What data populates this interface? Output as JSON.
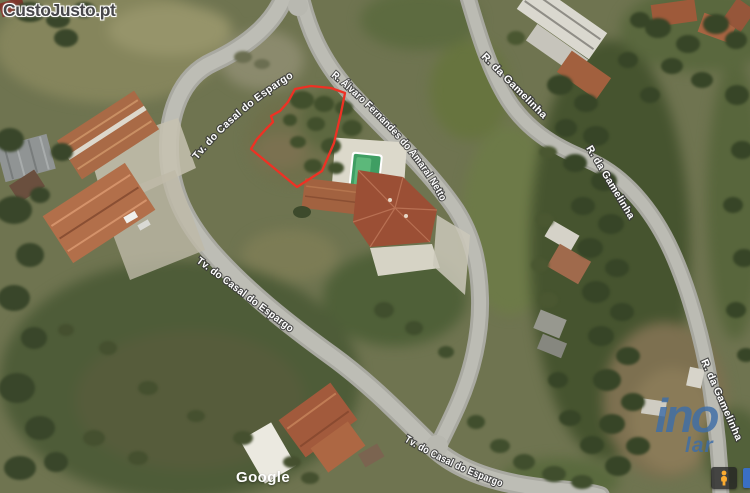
{
  "branding": {
    "watermark": "CustoJusto.pt",
    "attribution": "Google",
    "agency_line1": "ino",
    "agency_line2": "lar",
    "agency_color": "#3e6ea8"
  },
  "map": {
    "street_labels": [
      {
        "name": "Tv. do Casal do Espargo"
      },
      {
        "name": "Tv. do Casal do Espargo"
      },
      {
        "name": "Tv. do Casal do Espargo"
      },
      {
        "name": "R. Álvaro Fernandes do Amaral Netto"
      },
      {
        "name": "R. da Gamelinha"
      },
      {
        "name": "R. da Gamelinha"
      },
      {
        "name": "R. da Gamelinha"
      }
    ],
    "parcel_overlay": {
      "color": "#ee3124",
      "points": "295,89 311,86 331,88 345,93 341,113 334,143 322,171 297,187 251,149 257,139 266,129 273,122 271,116 280,111 288,102 295,89"
    },
    "controls": {
      "pegman": "street-view-pegman"
    }
  }
}
